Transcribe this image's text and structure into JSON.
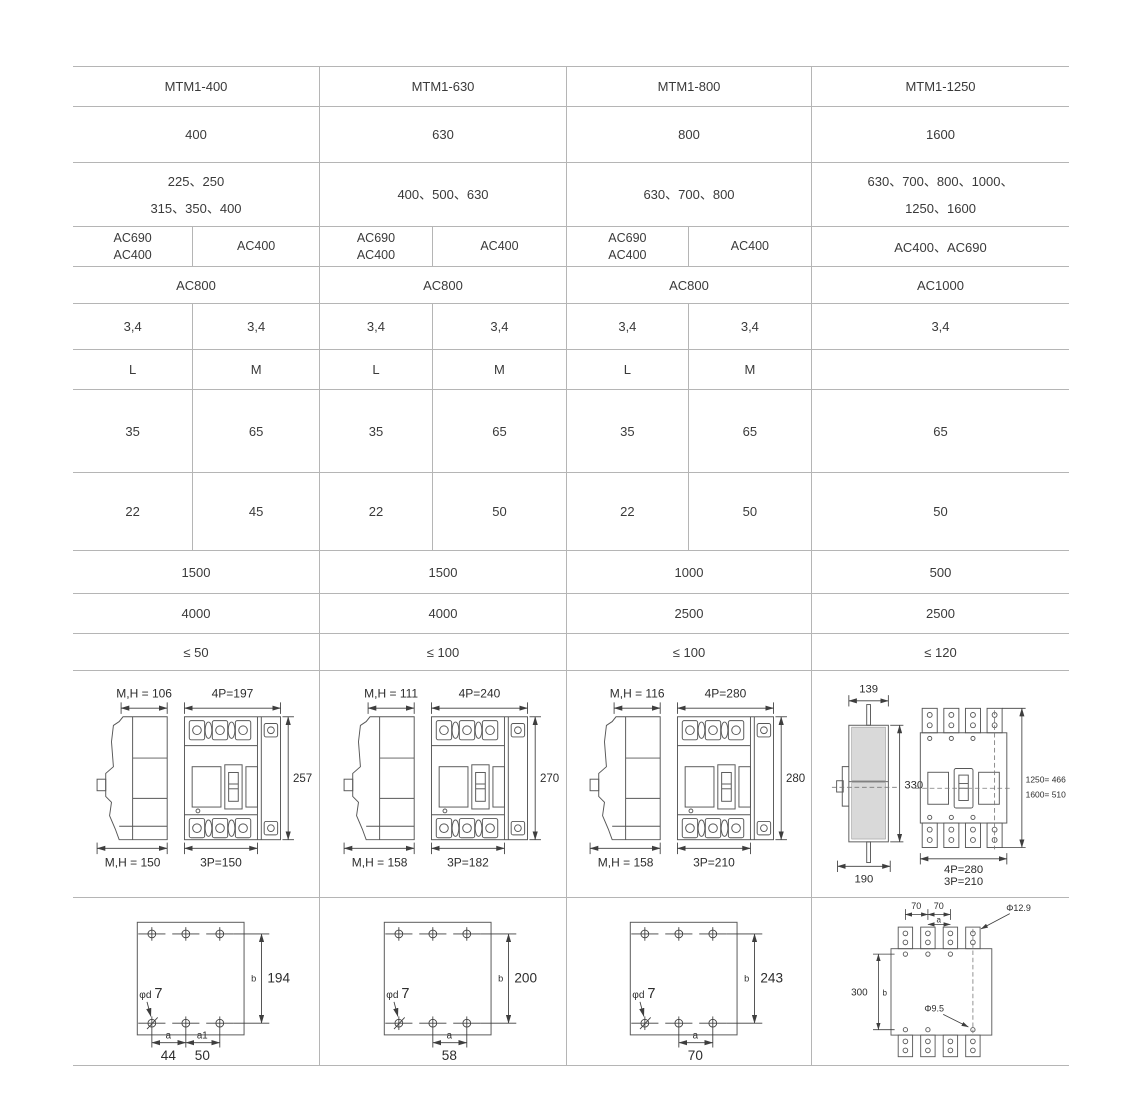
{
  "page": {
    "background": "#ffffff",
    "grid_line_color": "#b5b5b5",
    "text_color": "#3a3a3a",
    "drawing_line_color": "#575757",
    "shade_color": "#d9d9d9"
  },
  "table": {
    "columns": [
      {
        "model": "MTM1-400",
        "shell_current": "400",
        "rated_currents": "225、250\n315、350、400",
        "voltage_left": "AC690\nAC400",
        "voltage_right": "AC400",
        "insulation_voltage": "AC800",
        "poles_left": "3,4",
        "poles_right": "3,4",
        "grade_left": "L",
        "grade_right": "M",
        "icu_left": "35",
        "icu_right": "65",
        "ics_left": "22",
        "ics_right": "45",
        "electrical_life": "1500",
        "mechanical_life": "4000",
        "power_loss": "≤ 50"
      },
      {
        "model": "MTM1-630",
        "shell_current": "630",
        "rated_currents": "400、500、630",
        "voltage_left": "AC690\nAC400",
        "voltage_right": "AC400",
        "insulation_voltage": "AC800",
        "poles_left": "3,4",
        "poles_right": "3,4",
        "grade_left": "L",
        "grade_right": "M",
        "icu_left": "35",
        "icu_right": "65",
        "ics_left": "22",
        "ics_right": "50",
        "electrical_life": "1500",
        "mechanical_life": "4000",
        "power_loss": "≤ 100"
      },
      {
        "model": "MTM1-800",
        "shell_current": "800",
        "rated_currents": "630、700、800",
        "voltage_left": "AC690\nAC400",
        "voltage_right": "AC400",
        "insulation_voltage": "AC800",
        "poles_left": "3,4",
        "poles_right": "3,4",
        "grade_left": "L",
        "grade_right": "M",
        "icu_left": "35",
        "icu_right": "65",
        "ics_left": "22",
        "ics_right": "50",
        "electrical_life": "1000",
        "mechanical_life": "2500",
        "power_loss": "≤ 100"
      },
      {
        "model": "MTM1-1250",
        "shell_current": "1600",
        "rated_currents": "630、700、800、1000、\n1250、1600",
        "voltage_full": "AC400、AC690",
        "insulation_voltage": "AC1000",
        "poles_full": "3,4",
        "grade_full": "",
        "icu_full": "65",
        "ics_full": "50",
        "electrical_life": "500",
        "mechanical_life": "2500",
        "power_loss": "≤ 120"
      }
    ]
  },
  "outline_drawings": [
    {
      "depth_top": "M,H = 106",
      "width_4p": "4P=197",
      "height": "257",
      "depth_bottom": "M,H = 150",
      "width_3p": "3P=150"
    },
    {
      "depth_top": "M,H = 111",
      "width_4p": "4P=240",
      "height": "270",
      "depth_bottom": "M,H = 158",
      "width_3p": "3P=182"
    },
    {
      "depth_top": "M,H = 116",
      "width_4p": "4P=280",
      "height": "280",
      "depth_bottom": "M,H = 158",
      "width_3p": "3P=210"
    }
  ],
  "outline_drawing_1250": {
    "width_top": "139",
    "width_bottom": "190",
    "side_height": "330",
    "height_note_line1": "1250= 466",
    "height_note_line2": "1600= 510",
    "width_4p": "4P=280",
    "width_3p": "3P=210"
  },
  "mounting_drawings": [
    {
      "hole_symbol": "φd",
      "hole_dia": "7",
      "b_label": "b",
      "b_value": "194",
      "a_label": "a",
      "a_value": "44",
      "a1_label": "a1",
      "a1_value": "50"
    },
    {
      "hole_symbol": "φd",
      "hole_dia": "7",
      "b_label": "b",
      "b_value": "200",
      "a_label": "a",
      "a_value": "58"
    },
    {
      "hole_symbol": "φd",
      "hole_dia": "7",
      "b_label": "b",
      "b_value": "243",
      "a_label": "a",
      "a_value": "70"
    }
  ],
  "mounting_drawing_1250": {
    "pitch_left": "70",
    "pitch_right": "70",
    "a_label": "a",
    "top_hole_dia": "Φ12.9",
    "b_value": "300",
    "b_label": "b",
    "bottom_hole_dia": "Φ9.5"
  }
}
